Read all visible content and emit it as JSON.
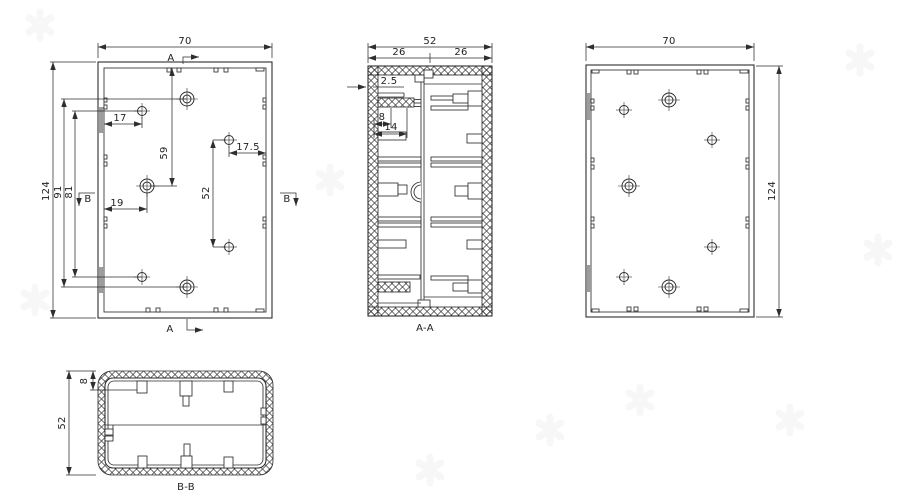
{
  "colors": {
    "line": "#2e2e2e",
    "bg": "#ffffff",
    "shade": "#9c9c9c",
    "watermark": "#f0f0f0"
  },
  "front_view": {
    "width": "70",
    "height": "124",
    "hole_span_outer": "91",
    "hole_span_inner": "81",
    "top_to_hole": "59",
    "offset_left_hole": "17",
    "offset_right_hole": "17.5",
    "offset_center_hole": "19",
    "right_hole_span": "52",
    "marker_a": "A",
    "marker_b": "B"
  },
  "section_aa": {
    "label": "A-A",
    "width": "52",
    "half_left": "26",
    "half_right": "26",
    "wall_thickness": "2.5",
    "boss_step": "8",
    "boss_length": "14"
  },
  "back_view": {
    "width": "70",
    "height": "124"
  },
  "section_bb": {
    "label": "B-B",
    "depth": "52",
    "rim": "8"
  }
}
